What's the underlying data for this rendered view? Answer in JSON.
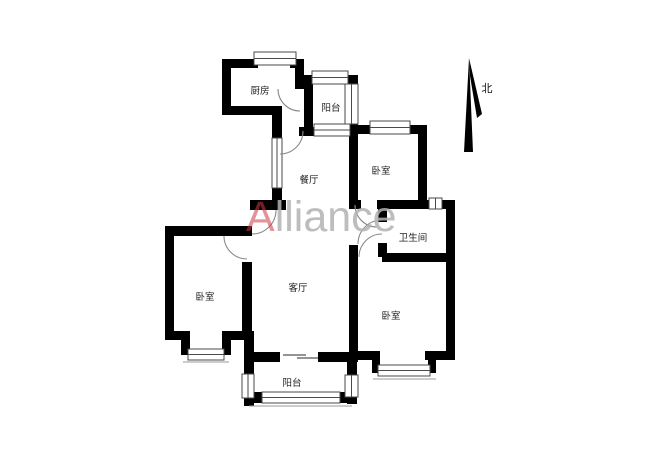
{
  "watermark": {
    "brand_a": "A",
    "brand_rest": "lliance"
  },
  "compass": {
    "north_label": "北"
  },
  "rooms": {
    "kitchen": {
      "label": "厨房"
    },
    "balcony_top": {
      "label": "阳台"
    },
    "dining": {
      "label": "餐厅"
    },
    "bedroom_top_right": {
      "label": "卧室"
    },
    "bathroom": {
      "label": "卫生间"
    },
    "living": {
      "label": "客厅"
    },
    "bedroom_left": {
      "label": "卧室"
    },
    "bedroom_bottom_right": {
      "label": "卧室"
    },
    "balcony_bottom": {
      "label": "阳台"
    }
  },
  "colors": {
    "wall": "#000000",
    "window_stroke": "#4a4a4a",
    "door_stroke": "#8a8a8a",
    "watermark_a": "#cd3741",
    "watermark_rest": "#b2b2b2"
  }
}
